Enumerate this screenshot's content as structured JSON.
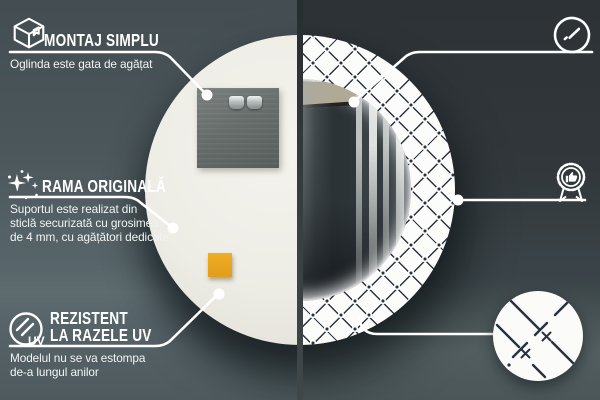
{
  "callouts": {
    "montaj": {
      "title": "MONTAJ SIMPLU",
      "desc": [
        "Oglinda este gata de agățat"
      ],
      "icon": "package-box-icon"
    },
    "rama": {
      "title": "RAMA ORIGINALĂ",
      "desc": [
        "Suportul este realizat din",
        "sticlă securizată cu grosimea",
        "de 4 mm, cu agățători dedicate"
      ],
      "icon": "sparkles-icon"
    },
    "uv": {
      "title_line1": "REZISTENT",
      "title_line2": "LA RAZELE UV",
      "desc": [
        "Modelul nu se va estompa",
        "de-a lungul anilor"
      ],
      "icon": "uv-resistant-icon",
      "icon_label": "UV"
    },
    "oglinda": {
      "title_line1": "OGLINDĂ DE",
      "title_line2": "CLASĂ SUPERIOARĂ",
      "desc": [
        "O suprafață perfect netedă,",
        "care nu deformează reflexia"
      ],
      "icon": "mirror-shine-icon"
    },
    "design": {
      "title": "DESIGN UNIC",
      "desc": [
        "Design atemporal",
        "pentru orice interior"
      ],
      "icon": "award-badge-icon"
    }
  },
  "colors": {
    "accent": "#ffffff",
    "bg_left_wall": "#4f5b5f",
    "bg_right_wall": "#32383c",
    "mirror_back": "#edece5",
    "pattern_line": "#2a3342",
    "sticker_orange": "#e7a41f"
  }
}
